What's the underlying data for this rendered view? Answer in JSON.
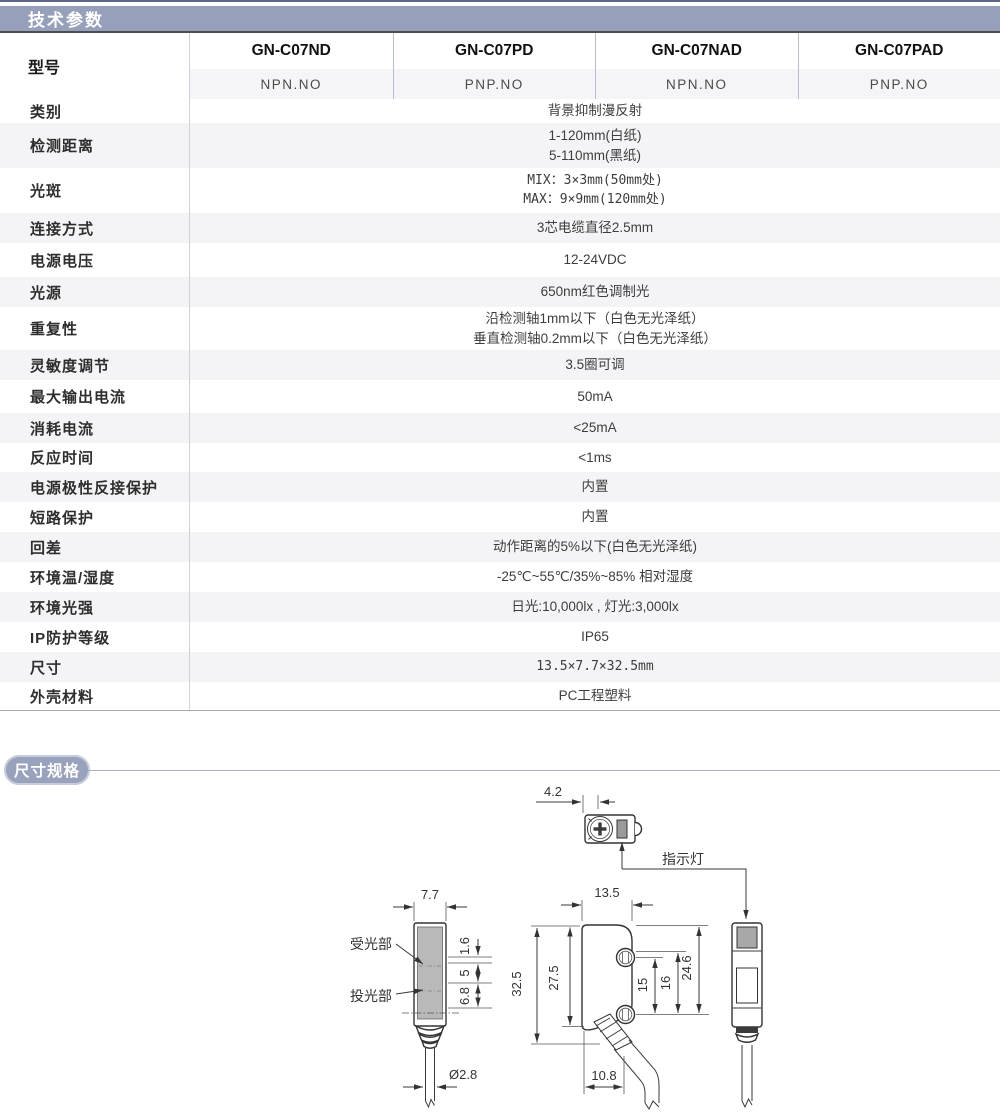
{
  "page": {
    "tech_header": "技术参数",
    "dim_header": "尺寸规格"
  },
  "colors": {
    "section_bar": "#97a0bb",
    "row_stripe": "#f4f4f6",
    "lens_fill": "#b9b9b9",
    "indicator_fill": "#a8a8a8"
  },
  "table": {
    "model_label": "型号",
    "models": [
      "GN-C07ND",
      "GN-C07PD",
      "GN-C07NAD",
      "GN-C07PAD"
    ],
    "outputs": [
      "NPN.NO",
      "PNP.NO",
      "NPN.NO",
      "PNP.NO"
    ],
    "rows": [
      {
        "label": "类别",
        "value": "背景抑制漫反射"
      },
      {
        "label": "检测距离",
        "value": "1-120mm(白纸)\n5-110mm(黑纸)"
      },
      {
        "label": "光斑",
        "value": "MIX：3×3mm(50mm处)\nMAX：9×9mm(120mm处)"
      },
      {
        "label": "连接方式",
        "value": "3芯电缆直径2.5mm"
      },
      {
        "label": "电源电压",
        "value": "12-24VDC"
      },
      {
        "label": "光源",
        "value": "650nm红色调制光"
      },
      {
        "label": "重复性",
        "value": "沿检测轴1mm以下（白色无光泽纸）\n垂直检测轴0.2mm以下（白色无光泽纸）"
      },
      {
        "label": "灵敏度调节",
        "value": "3.5圈可调"
      },
      {
        "label": "最大输出电流",
        "value": "50mA"
      },
      {
        "label": "消耗电流",
        "value": "<25mA"
      },
      {
        "label": "反应时间",
        "value": "<1ms"
      },
      {
        "label": "电源极性反接保护",
        "value": "内置"
      },
      {
        "label": "短路保护",
        "value": "内置"
      },
      {
        "label": "回差",
        "value": "动作距离的5%以下(白色无光泽纸)"
      },
      {
        "label": "环境温/湿度",
        "value": "-25℃~55℃/35%~85% 相对湿度"
      },
      {
        "label": "环境光强",
        "value": "日光:10,000lx , 灯光:3,000lx"
      },
      {
        "label": "IP防护等级",
        "value": "IP65"
      },
      {
        "label": "尺寸",
        "value": "13.5×7.7×32.5mm"
      },
      {
        "label": "外壳材料",
        "value": "PC工程塑料"
      }
    ]
  },
  "diagram": {
    "indicator_label": "指示灯",
    "receiver_label": "受光部",
    "emitter_label": "投光部",
    "dims": {
      "adjuster_offset": "4.2",
      "front_width": "7.7",
      "receiver_inset": "1.6",
      "window_gap": "5",
      "emitter_inset": "6.8",
      "cable_diameter": "Ø2.8",
      "body_width": "13.5",
      "total_height": "32.5",
      "body_height": "27.5",
      "hole_pitch": "15",
      "hole_span": "16",
      "hole_offset": "24.6",
      "cable_exit_width": "10.8"
    }
  }
}
